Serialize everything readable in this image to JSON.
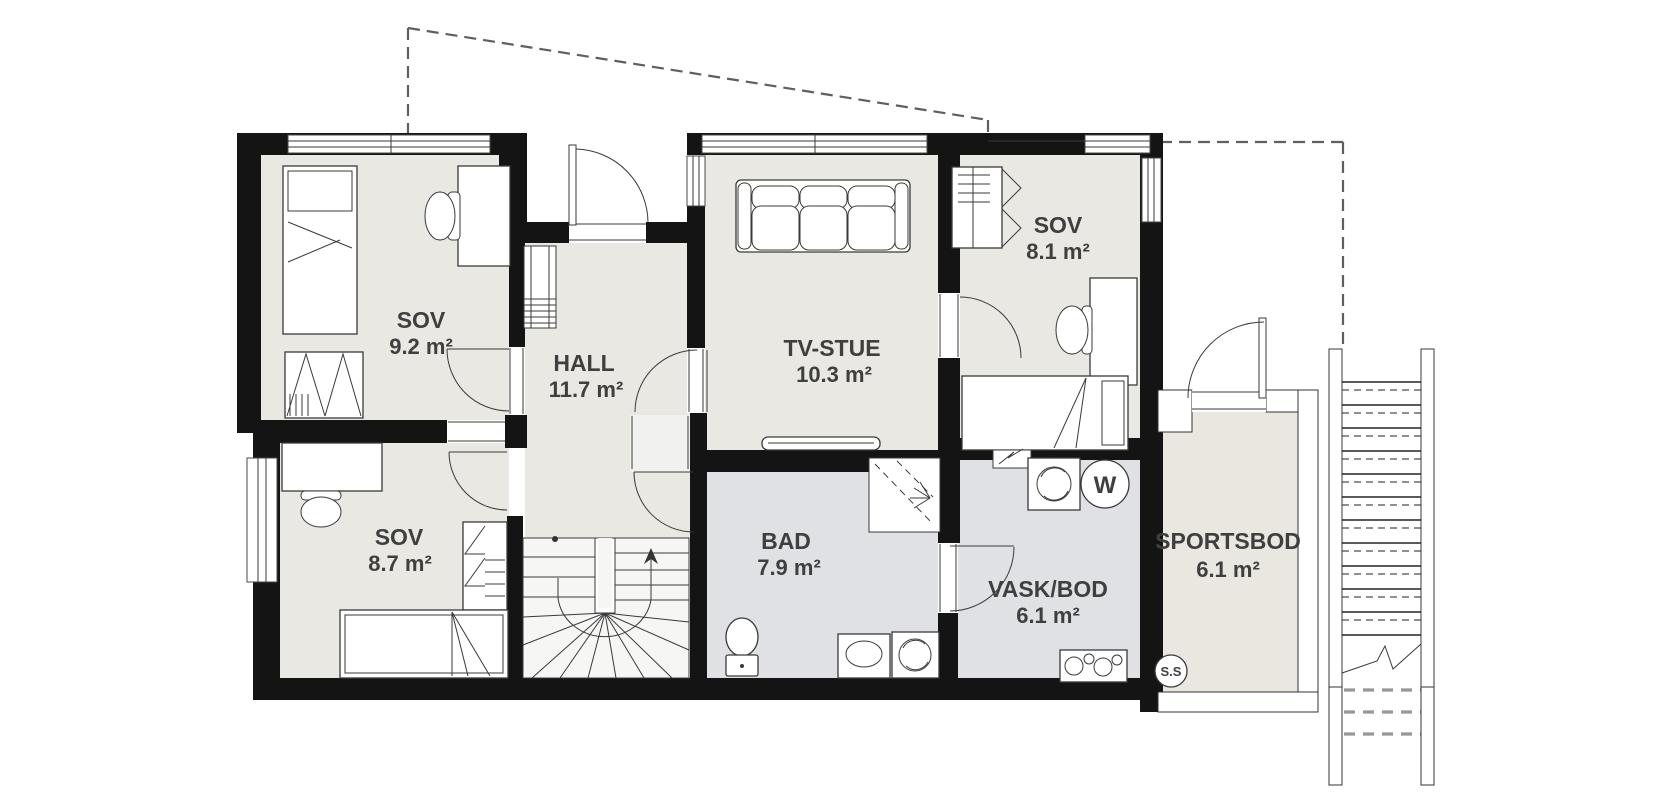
{
  "plan": {
    "type": "floorplan",
    "rooms": [
      {
        "id": "sov-1",
        "name": "SOV",
        "area": "9.2 m²"
      },
      {
        "id": "hall",
        "name": "HALL",
        "area": "11.7 m²"
      },
      {
        "id": "tv-stue",
        "name": "TV-STUE",
        "area": "10.3 m²"
      },
      {
        "id": "sov-2",
        "name": "SOV",
        "area": "8.1 m²"
      },
      {
        "id": "sov-3",
        "name": "SOV",
        "area": "8.7 m²"
      },
      {
        "id": "bad",
        "name": "BAD",
        "area": "7.9 m²"
      },
      {
        "id": "vask-bod",
        "name": "VASK/BOD",
        "area": "6.1 m²"
      },
      {
        "id": "sportsbod",
        "name": "SPORTSBOD",
        "area": "6.1 m²"
      }
    ],
    "markers": {
      "hot_water_tank": "W",
      "sportsbod_marker": "S.S"
    },
    "colors": {
      "wall": "#141414",
      "floor-warm": "#e9e8e3",
      "floor-wet": "#dfe1e4",
      "floor-storage": "#e9e7df",
      "floor-stair": "#f6f6f4",
      "outline": "#3a3a3a",
      "label": "#3f3f3f",
      "dash": "#5f5f5f"
    }
  }
}
